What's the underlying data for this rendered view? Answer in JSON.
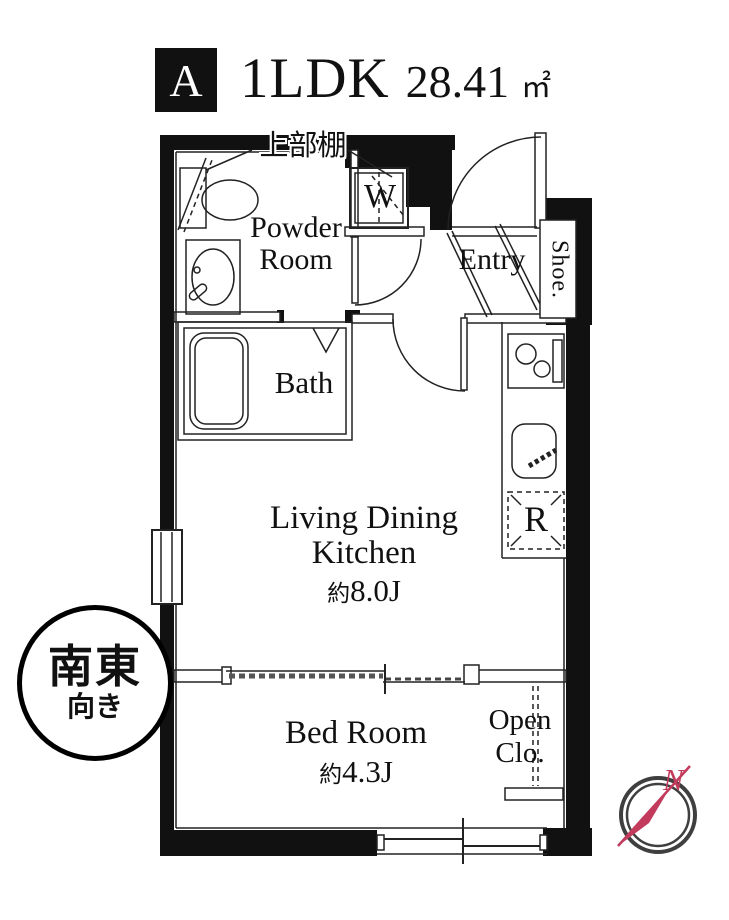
{
  "header": {
    "unit_label": "A",
    "layout_label": "1LDK",
    "area_value": "28.41",
    "area_unit": "㎡"
  },
  "labels": {
    "upper_shelf": "上部棚",
    "powder_room_line1": "Powder",
    "powder_room_line2": "Room",
    "washing_machine": "W",
    "entry": "Entry",
    "shoe_cabinet": "Shoe.",
    "bath": "Bath",
    "refrigerator": "R",
    "ldk_line1": "Living Dining",
    "ldk_line2": "Kitchen",
    "ldk_size_prefix": "約",
    "ldk_size_value": "8.0J",
    "bedroom": "Bed Room",
    "bedroom_size_prefix": "約",
    "bedroom_size_value": "4.3J",
    "open_closet_line1": "Open",
    "open_closet_line2": "Clo."
  },
  "orientation_badge": {
    "direction": "南東",
    "suffix": "向き"
  },
  "compass": {
    "north_label": "N"
  },
  "colors": {
    "wall": "#111111",
    "line": "#2b2b2b",
    "compass_ring": "#3f3f3f",
    "compass_needle": "#c23a5c",
    "background": "#ffffff"
  }
}
